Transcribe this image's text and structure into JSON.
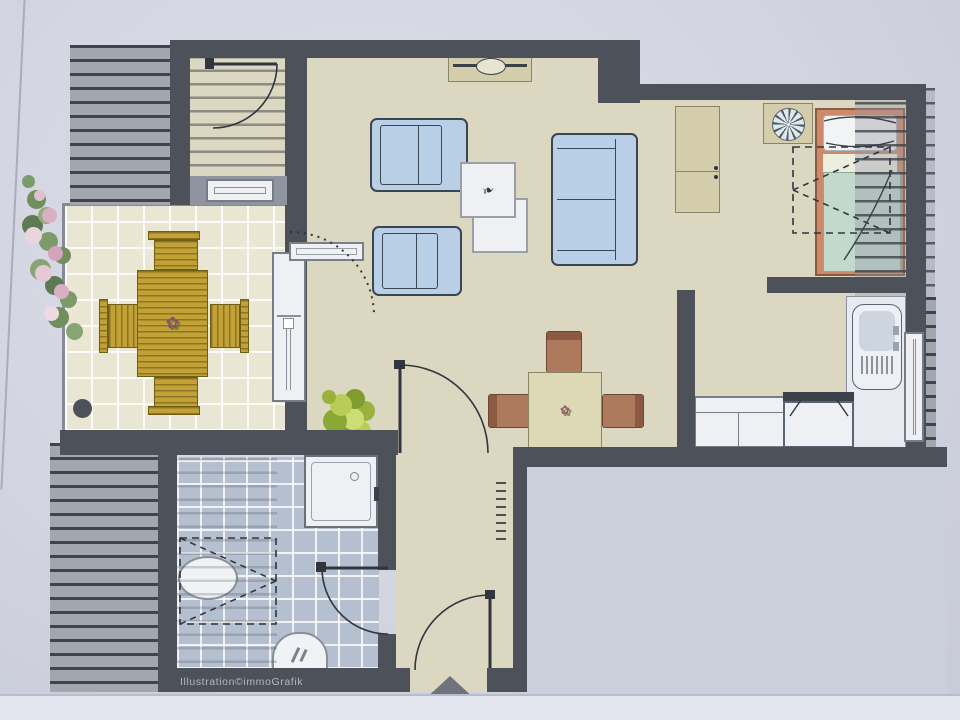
{
  "watermark": {
    "label": "Illustration©immoGrafik"
  },
  "decor": {
    "flower": "✿",
    "sprig": "❧",
    "entrance_marker": "triangle-up"
  },
  "colors": {
    "background": "#d5d7e2",
    "wall": "#4d515a",
    "floor": "#dcd7c0",
    "terrace_tile": "#e9e6d4",
    "bath_tile": "#b4bfd0",
    "hatch": "#a2a6ae",
    "outside_area": "#cbcfdb",
    "sofa_blue": "#b9cfe6",
    "wood_gold": "#c2a238",
    "chair_brown": "#ad7a5e",
    "cabinet_beige": "#d4cdab",
    "bed_frame": "#cd8a6b",
    "bed_blanket": "#c3d9cb",
    "fixture_white": "#eef0f4",
    "watermark_gray": "#b6b9c2"
  }
}
